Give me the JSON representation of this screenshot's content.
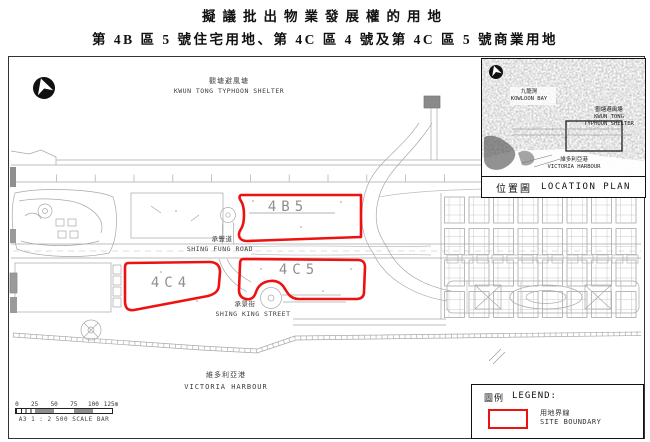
{
  "title": {
    "line1": "擬議批出物業發展權的用地",
    "line2": "第 4B 區 5 號住宅用地、第 4C 區 4 號及第 4C 區 5 號商業用地"
  },
  "map": {
    "labels": {
      "typhoon_shelter_zh": "觀塘避風塘",
      "typhoon_shelter_en": "KWUN TONG TYPHOON SHELTER",
      "shing_fung_road_zh": "承豐道",
      "shing_fung_road_en": "SHING FUNG ROAD",
      "shing_king_street_zh": "承景街",
      "shing_king_street_en": "SHING KING STREET",
      "victoria_harbour_zh": "維多利亞港",
      "victoria_harbour_en": "VICTORIA HARBOUR"
    },
    "sites": [
      {
        "id": "4B5"
      },
      {
        "id": "4C4"
      },
      {
        "id": "4C5"
      }
    ],
    "scale_bar": {
      "ticks": [
        "0",
        "25",
        "50",
        "75",
        "100",
        "125m"
      ],
      "caption": "A3 1 : 2 500 SCALE BAR"
    }
  },
  "inset": {
    "labels": {
      "kowloon_bay_zh": "九龍灣",
      "kowloon_bay_en": "KOWLOON BAY",
      "typhoon_shelter_zh": "觀塘避風塘",
      "typhoon_shelter_en_line1": "KWUN TONG",
      "typhoon_shelter_en_line2": "TYPHOON SHELTER",
      "victoria_harbour_zh": "維多利亞港",
      "victoria_harbour_en": "VICTORIA HARBOUR"
    },
    "caption_zh": "位置圖",
    "caption_en": "LOCATION PLAN"
  },
  "legend": {
    "heading_zh": "圖例",
    "heading_en": "LEGEND:",
    "items": [
      {
        "zh": "用地界線",
        "en": "SITE BOUNDARY"
      }
    ]
  },
  "colors": {
    "site_boundary_red": "#ee1111",
    "cad_line_gray": "#a8a8a8"
  }
}
